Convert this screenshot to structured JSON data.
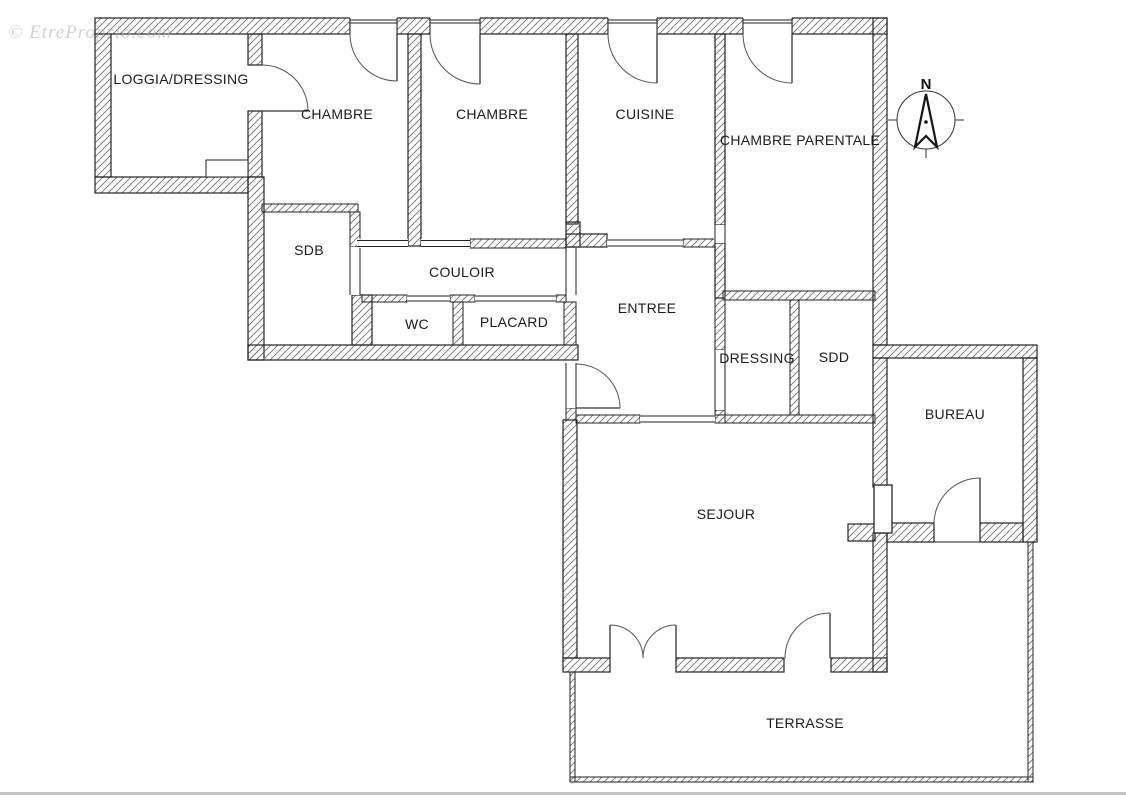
{
  "watermark": {
    "text": "© EtreProprio.com"
  },
  "compass": {
    "north_label": "N"
  },
  "rooms": [
    {
      "id": "loggia-dressing",
      "label": "LOGGIA/DRESSING"
    },
    {
      "id": "chambre-1",
      "label": "CHAMBRE"
    },
    {
      "id": "chambre-2",
      "label": "CHAMBRE"
    },
    {
      "id": "cuisine",
      "label": "CUISINE"
    },
    {
      "id": "chambre-parentale",
      "label": "CHAMBRE PARENTALE"
    },
    {
      "id": "sdb",
      "label": "SDB"
    },
    {
      "id": "couloir",
      "label": "COULOIR"
    },
    {
      "id": "wc",
      "label": "WC"
    },
    {
      "id": "placard",
      "label": "PLACARD"
    },
    {
      "id": "entree",
      "label": "ENTREE"
    },
    {
      "id": "dressing",
      "label": "DRESSING"
    },
    {
      "id": "sdd",
      "label": "SDD"
    },
    {
      "id": "bureau",
      "label": "BUREAU"
    },
    {
      "id": "sejour",
      "label": "SEJOUR"
    },
    {
      "id": "terrasse",
      "label": "TERRASSE"
    }
  ],
  "colors": {
    "wall_line": "#222222",
    "hatch_line": "#6e6e6e",
    "label_text": "#1b1b1b",
    "page_bottom_border": "#c4c4c4"
  }
}
